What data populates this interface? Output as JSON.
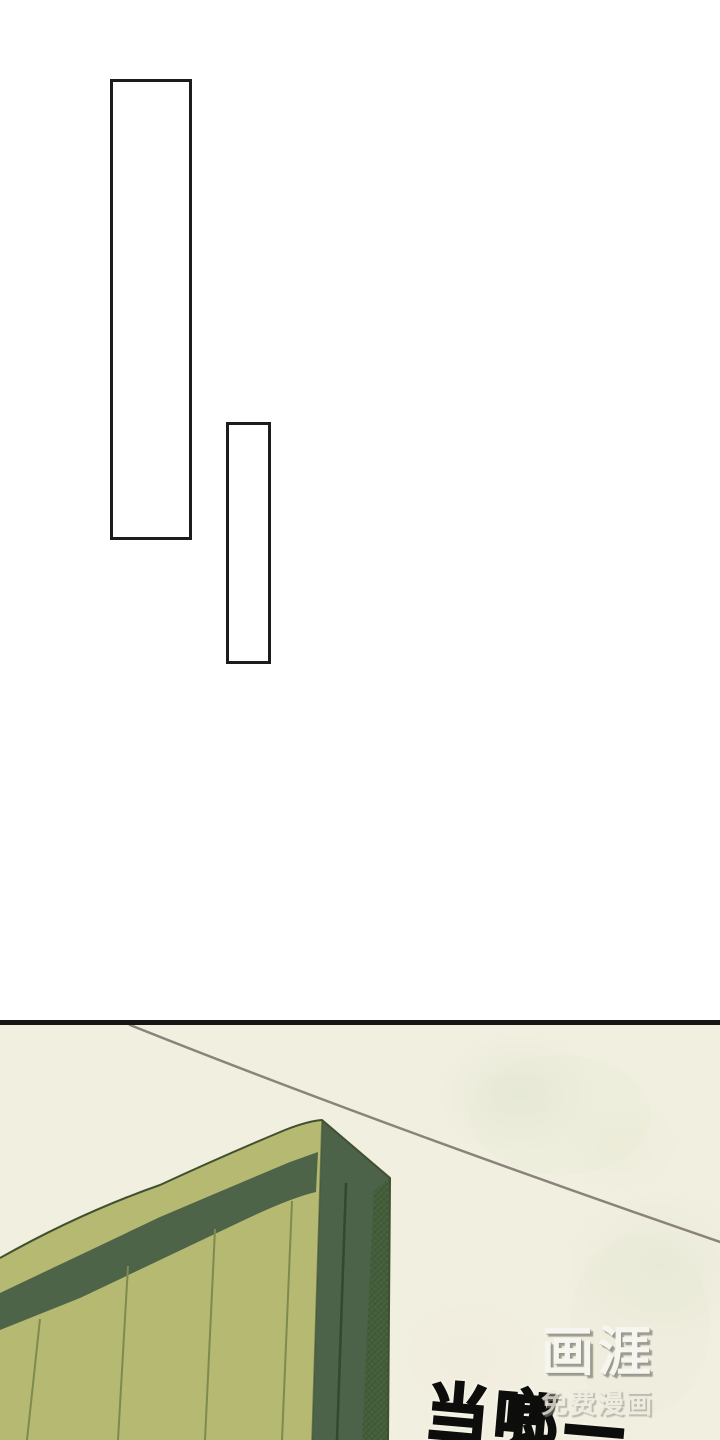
{
  "page": {
    "width_px": 720,
    "height_px": 1440,
    "kind": "webtoon comic page"
  },
  "top_section": {
    "speech_bubbles": [
      {
        "shape": "tall-rectangle",
        "text": ""
      },
      {
        "shape": "tall-rectangle",
        "text": ""
      }
    ]
  },
  "comic_panel": {
    "sfx": {
      "text": "当啷—"
    },
    "watermark": {
      "logo": "画涯",
      "subtitle": "免费漫画"
    },
    "scene": {
      "subject": "green-arched-gate-with-power-line"
    }
  },
  "palette": {
    "page_bg": "#ffffff",
    "bubble_border": "#1c1c1c",
    "divider": "#161616",
    "panel_bg": "#f1efe0",
    "panel_tint": "#dde4c8",
    "face_green": "#b5b972",
    "band_green": "#4e6448",
    "side_green": "#4c6349",
    "hatch_base": "#47613e",
    "hatch_line": "#2f4529",
    "seam_line": "#7f8a4e",
    "side_seam": "#33482c",
    "outline_dark": "#41502e",
    "wire": "#8a8478",
    "sfx_color": "#0d0d0b",
    "sfx_halo": "#f4f2e4",
    "watermark_color": "#f7f6f1",
    "watermark_shadow": "#8c8a7e"
  }
}
